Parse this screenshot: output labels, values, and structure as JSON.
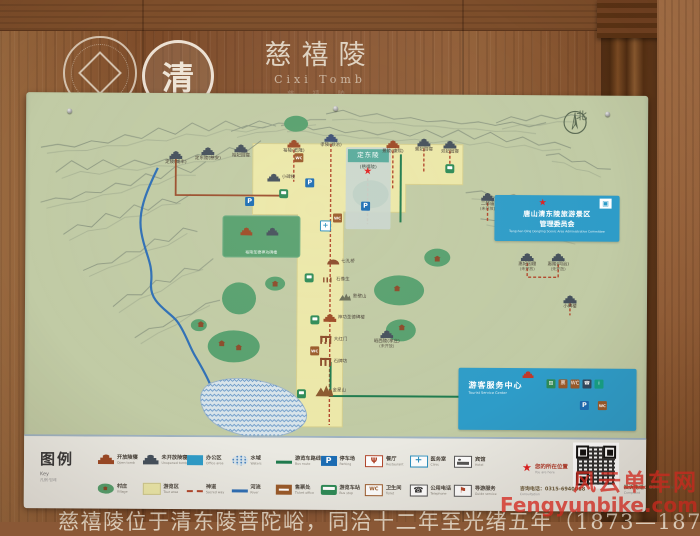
{
  "photo": {
    "watermark_line1": "风云单车网",
    "watermark_line2": "Fengyunbike.com"
  },
  "sign": {
    "header": {
      "title": "慈禧陵",
      "subtitle": "Cixi Tomb",
      "subtitle2": "慈 禧 陵",
      "site_logo_char": "清"
    },
    "map": {
      "compass": "北",
      "highlight": {
        "name": "定东陵",
        "sub": "(慈禧陵)"
      },
      "green_area_caption": "裕陵圣德神功碑楼",
      "admin_box": {
        "line1": "唐山清东陵旅游景区",
        "line2": "管理委员会",
        "en1": "Tangshan Qing Dongling Scenic Area Administrative Committee"
      },
      "service_center": {
        "name": "游客服务中心",
        "en": "Tourist Service Center"
      },
      "places": [
        {
          "i": "tomb-dark",
          "x": 150,
          "y": 62,
          "n": "定陵(咸丰)"
        },
        {
          "i": "tomb-dark",
          "x": 182,
          "y": 58,
          "n": "定东陵(慈安)"
        },
        {
          "i": "tomb-dark",
          "x": 215,
          "y": 55,
          "n": "裕妃园寝"
        },
        {
          "i": "tomb-red",
          "x": 268,
          "y": 50,
          "n": "裕陵(乾隆)"
        },
        {
          "i": "tomb-blue",
          "x": 305,
          "y": 44,
          "n": "孝陵(顺治)"
        },
        {
          "i": "tomb-red",
          "x": 367,
          "y": 50,
          "n": "景陵(康熙)"
        },
        {
          "i": "tomb-dark",
          "x": 398,
          "y": 48,
          "n": "景妃园寝"
        },
        {
          "i": "tomb-dark",
          "x": 424,
          "y": 50,
          "n": "双妃园寝"
        },
        {
          "i": "tomb-dark",
          "x": 462,
          "y": 102,
          "n": "二郎庙",
          "s": "(未开放)"
        },
        {
          "i": "tomb-dark",
          "x": 502,
          "y": 162,
          "n": "惠妃园寝",
          "s": "(未开放)"
        },
        {
          "i": "tomb-dark",
          "x": 533,
          "y": 162,
          "n": "惠陵(同治)",
          "s": "(未开放)"
        },
        {
          "i": "tomb-dark",
          "x": 545,
          "y": 204,
          "n": "小碑楼"
        },
        {
          "i": "tomb-dark",
          "x": 362,
          "y": 240,
          "n": "昭西陵(孝庄)",
          "s": "(未开放)"
        },
        {
          "i": "tomb-dark",
          "x": 248,
          "y": 84,
          "n": "小碑楼",
          "lp": "r"
        },
        {
          "i": "bridge",
          "x": 308,
          "y": 168,
          "n": "七孔桥",
          "lp": "r"
        },
        {
          "i": "statues",
          "x": 303,
          "y": 186,
          "n": "石像生",
          "lp": "r"
        },
        {
          "i": "mountain",
          "x": 320,
          "y": 203,
          "n": "影壁山",
          "lp": "r"
        },
        {
          "i": "tomb-red",
          "x": 305,
          "y": 224,
          "n": "神功圣德碑楼",
          "lp": "r"
        },
        {
          "i": "gate",
          "x": 301,
          "y": 246,
          "n": "大红门",
          "lp": "r"
        },
        {
          "i": "gate",
          "x": 301,
          "y": 268,
          "n": "石牌坊",
          "lp": "r"
        },
        {
          "i": "mountain-lg",
          "x": 300,
          "y": 297,
          "n": "金星山",
          "lp": "r"
        },
        {
          "i": "star",
          "x": 342,
          "y": 78
        },
        {
          "i": "p",
          "x": 284,
          "y": 89
        },
        {
          "i": "p",
          "x": 340,
          "y": 112
        },
        {
          "i": "p",
          "x": 224,
          "y": 108
        },
        {
          "i": "p",
          "x": 560,
          "y": 310
        },
        {
          "i": "wc",
          "x": 273,
          "y": 64
        },
        {
          "i": "wc",
          "x": 312,
          "y": 124
        },
        {
          "i": "wc",
          "x": 290,
          "y": 257
        },
        {
          "i": "wc",
          "x": 578,
          "y": 310
        },
        {
          "i": "bus",
          "x": 284,
          "y": 184
        },
        {
          "i": "bus",
          "x": 290,
          "y": 226
        },
        {
          "i": "bus",
          "x": 277,
          "y": 300
        },
        {
          "i": "bus",
          "x": 424,
          "y": 74
        },
        {
          "i": "bus",
          "x": 258,
          "y": 100
        },
        {
          "i": "clinic",
          "x": 300,
          "y": 132
        },
        {
          "i": "house",
          "x": 197,
          "y": 250
        },
        {
          "i": "house",
          "x": 214,
          "y": 254
        },
        {
          "i": "house",
          "x": 250,
          "y": 190
        },
        {
          "i": "house",
          "x": 372,
          "y": 194
        },
        {
          "i": "house",
          "x": 377,
          "y": 233
        },
        {
          "i": "house",
          "x": 412,
          "y": 164
        },
        {
          "i": "house",
          "x": 176,
          "y": 231
        }
      ]
    },
    "legend": {
      "title": "图例",
      "sub1": "Key",
      "sub2": "凡例·범례",
      "items": [
        {
          "label": "开放陵寝",
          "en": "Open tomb",
          "icon": "tomb-red"
        },
        {
          "label": "村庄",
          "en": "Village",
          "icon": "village"
        },
        {
          "label": "未开放陵寝",
          "en": "Unopened tomb",
          "icon": "tomb-dark"
        },
        {
          "label": "游览区",
          "en": "Tour area",
          "icon": "yellow"
        },
        {
          "label": "办公区",
          "en": "Office area",
          "icon": "blue"
        },
        {
          "label": "神道",
          "en": "Sacred way",
          "icon": "red-dash"
        },
        {
          "label": "水域",
          "en": "Waters",
          "icon": "lake"
        },
        {
          "label": "河流",
          "en": "River",
          "icon": "blue-line"
        },
        {
          "label": "游览车路线",
          "en": "Bus route",
          "icon": "green-line"
        },
        {
          "label": "售票处",
          "en": "Ticket office",
          "icon": "ticket"
        },
        {
          "label": "停车场",
          "en": "Parking",
          "icon": "parking"
        },
        {
          "label": "游览车站",
          "en": "Bus stop",
          "icon": "bus"
        },
        {
          "label": "餐厅",
          "en": "Restaurant",
          "icon": "restaurant"
        },
        {
          "label": "卫生间",
          "en": "Toilet",
          "icon": "wc"
        },
        {
          "label": "医务室",
          "en": "Clinic",
          "icon": "clinic"
        },
        {
          "label": "公用电话",
          "en": "Telephone",
          "icon": "phone"
        },
        {
          "label": "宾馆",
          "en": "Hotel",
          "icon": "hotel"
        },
        {
          "label": "导游服务",
          "en": "Guide service",
          "icon": "guide"
        }
      ],
      "you_are_here": {
        "label": "您的所在位置",
        "en": "You are here"
      },
      "consult": "咨询电话：0315-6940088",
      "consult_en": "Consultation",
      "complaint": "投诉电话：0315-6940012",
      "complaint_en": "Complaint"
    },
    "footer": "慈禧陵位于清东陵菩陀峪，同治十二年至光绪五年（1873—1879）建成"
  }
}
